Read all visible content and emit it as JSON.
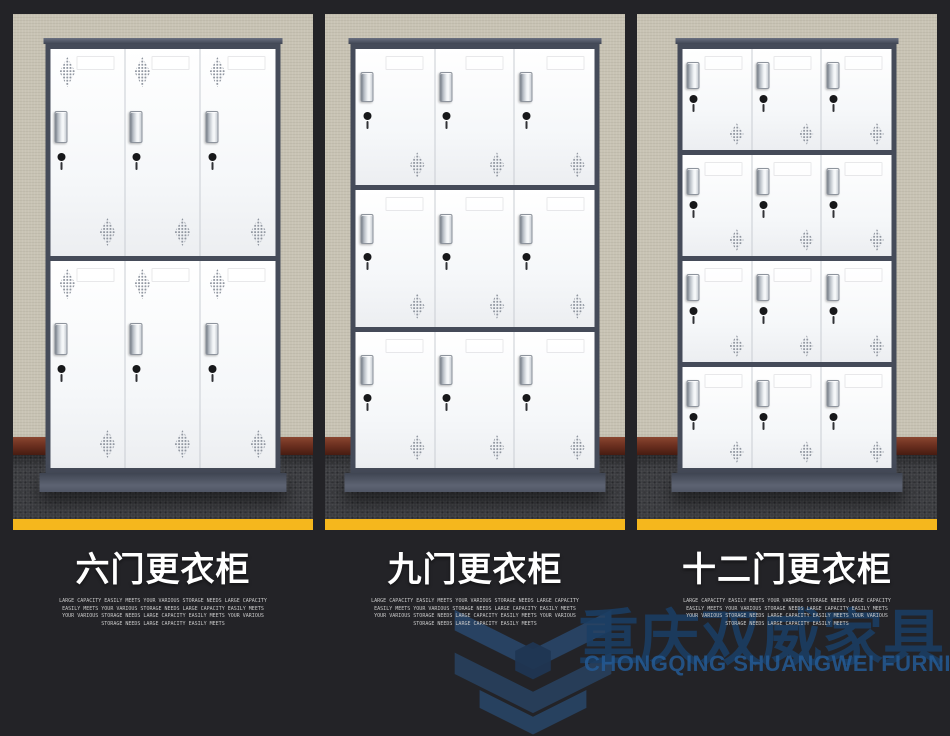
{
  "colors": {
    "background": "#232327",
    "accent_yellow": "#f5b71d",
    "wall": "#c8c3b4",
    "carpet": "#3b3c40",
    "baseboard": "#6b2f1f",
    "cabinet_frame": "#454b59",
    "door": "#f7f8f9",
    "title_text": "#ffffff",
    "desc_text": "#c9c9c9",
    "watermark_cn_blue": "#1b3e64",
    "watermark_en_blue": "#245a94"
  },
  "panels": [
    {
      "id": "six-door",
      "title": "六门更衣柜",
      "doors": {
        "rows": 2,
        "cols": 3,
        "count": 6,
        "layout": "tall"
      },
      "description_lines": [
        "LARGE CAPACITY EASILY MEETS YOUR VARIOUS STORAGE NEEDS LARGE CAPACITY",
        "EASILY MEETS YOUR VARIOUS STORAGE NEEDS LARGE CAPACITY EASILY MEETS",
        "YOUR VARIOUS STORAGE NEEDS LARGE CAPACITY EASILY MEETS YOUR VARIOUS",
        "STORAGE NEEDS LARGE CAPACITY EASILY MEETS"
      ]
    },
    {
      "id": "nine-door",
      "title": "九门更衣柜",
      "doors": {
        "rows": 3,
        "cols": 3,
        "count": 9,
        "layout": "mid"
      },
      "description_lines": [
        "LARGE CAPACITY EASILY MEETS YOUR VARIOUS STORAGE NEEDS LARGE CAPACITY",
        "EASILY MEETS YOUR VARIOUS STORAGE NEEDS LARGE CAPACITY EASILY MEETS",
        "YOUR VARIOUS STORAGE NEEDS LARGE CAPACITY EASILY MEETS YOUR VARIOUS",
        "STORAGE NEEDS LARGE CAPACITY EASILY MEETS"
      ]
    },
    {
      "id": "twelve-door",
      "title": "十二门更衣柜",
      "doors": {
        "rows": 4,
        "cols": 3,
        "count": 12,
        "layout": "short"
      },
      "description_lines": [
        "LARGE CAPACITY EASILY MEETS YOUR VARIOUS STORAGE NEEDS LARGE CAPACITY",
        "EASILY MEETS YOUR VARIOUS STORAGE NEEDS LARGE CAPACITY EASILY MEETS",
        "YOUR VARIOUS STORAGE NEEDS LARGE CAPACITY EASILY MEETS YOUR VARIOUS",
        "STORAGE NEEDS LARGE CAPACITY EASILY MEETS"
      ]
    }
  ],
  "watermark": {
    "logo_icon": "shuangwei-cube-logo",
    "brand_cn": "重庆双威家具",
    "brand_en": "CHONGQING SHUANGWEI FURNITURE"
  }
}
